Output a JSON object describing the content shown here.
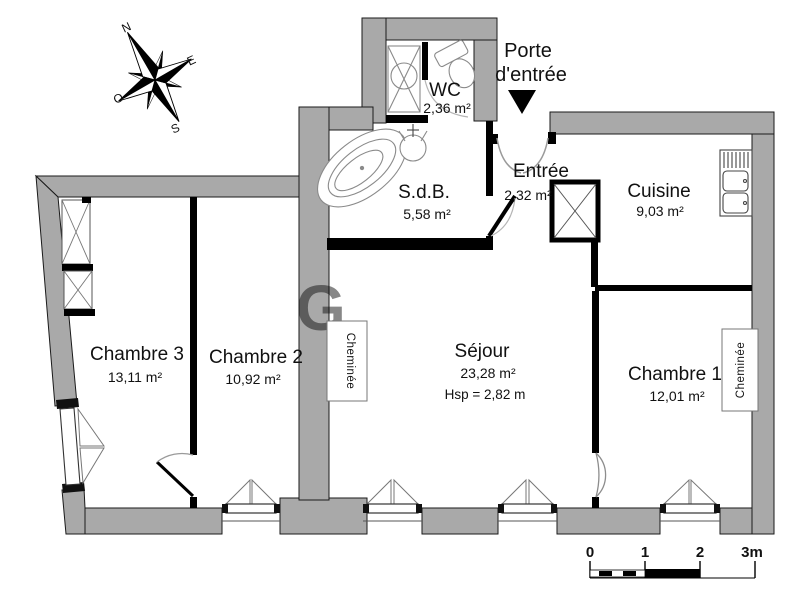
{
  "title": "Plan d'appartement",
  "colors": {
    "wall_gray": "#a9a9a9",
    "wall_black": "#000000",
    "background": "#ffffff",
    "fixture_stroke": "#8a8a8a"
  },
  "compass": {
    "north": "N",
    "east": "E",
    "south": "S",
    "west": "O"
  },
  "entrance": {
    "label_line1": "Porte",
    "label_line2": "d'entrée"
  },
  "rooms": {
    "wc": {
      "name": "WC",
      "area": "2,36 m²"
    },
    "sdb": {
      "name": "S.d.B.",
      "area": "5,58 m²"
    },
    "entree": {
      "name": "Entrée",
      "area": "2,32 m²"
    },
    "cuisine": {
      "name": "Cuisine",
      "area": "9,03 m²"
    },
    "sejour": {
      "name": "Séjour",
      "area": "23,28 m²",
      "ceiling_height": "Hsp = 2,82 m"
    },
    "chambre1": {
      "name": "Chambre 1",
      "area": "12,01 m²"
    },
    "chambre2": {
      "name": "Chambre 2",
      "area": "10,92 m²"
    },
    "chambre3": {
      "name": "Chambre 3",
      "area": "13,11 m²"
    }
  },
  "fireplaces": {
    "sejour": "Cheminée",
    "chambre1": "Cheminée"
  },
  "scale_bar": {
    "tick0": "0",
    "tick1": "1",
    "tick2": "2",
    "tick3": "3m"
  }
}
